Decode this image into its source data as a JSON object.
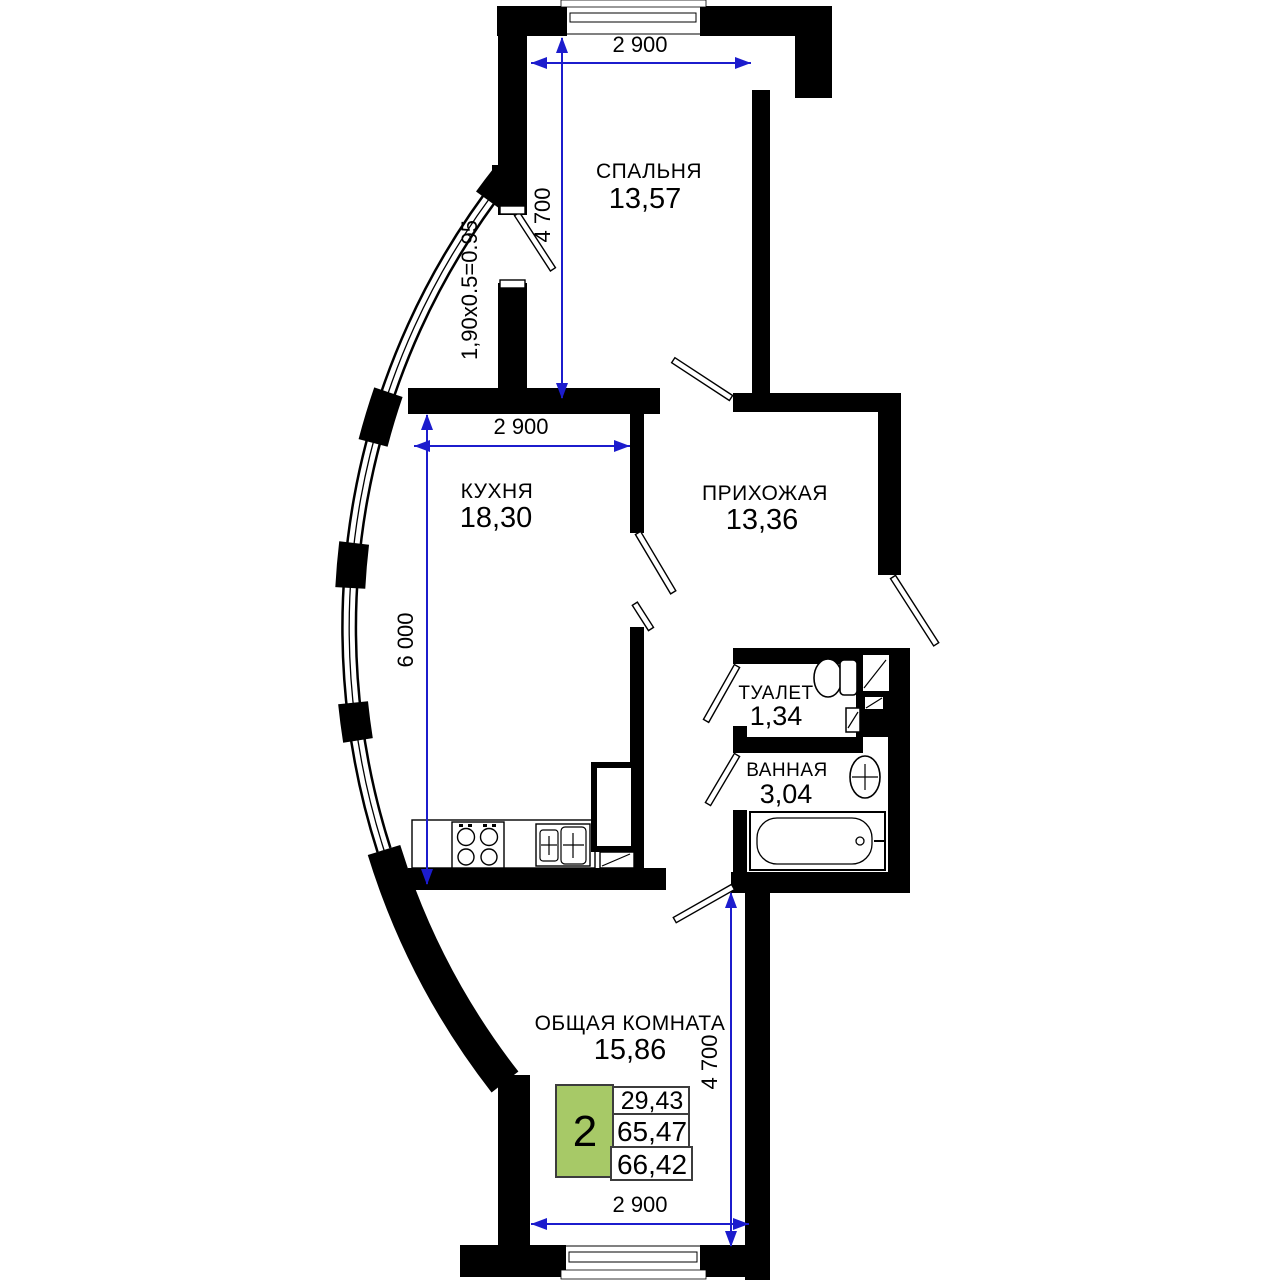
{
  "rooms": {
    "bedroom": {
      "name": "СПАЛЬНЯ",
      "area": "13,57"
    },
    "kitchen": {
      "name": "КУХНЯ",
      "area": "18,30"
    },
    "hallway": {
      "name": "ПРИХОЖАЯ",
      "area": "13,36"
    },
    "toilet": {
      "name": "ТУАЛЕТ",
      "area": "1,34"
    },
    "bathroom": {
      "name": "ВАННАЯ",
      "area": "3,04"
    },
    "living": {
      "name": "ОБЩАЯ КОМНАТА",
      "area": "15,86"
    }
  },
  "dimensions": {
    "bedroom_width": "2 900",
    "bedroom_depth": "4 700",
    "kitchen_width": "2 900",
    "kitchen_depth": "6 000",
    "living_width": "2 900",
    "living_depth": "4 700",
    "balcony_area_formula": "1,90x0.5=0.95"
  },
  "legend": {
    "room_count": "2",
    "living_area": "29,43",
    "apartment_area": "65,47",
    "total_area": "66,42"
  },
  "colors": {
    "wall": "#000000",
    "dimension_line": "#1c1ccd",
    "legend_highlight": "#a7c967"
  }
}
